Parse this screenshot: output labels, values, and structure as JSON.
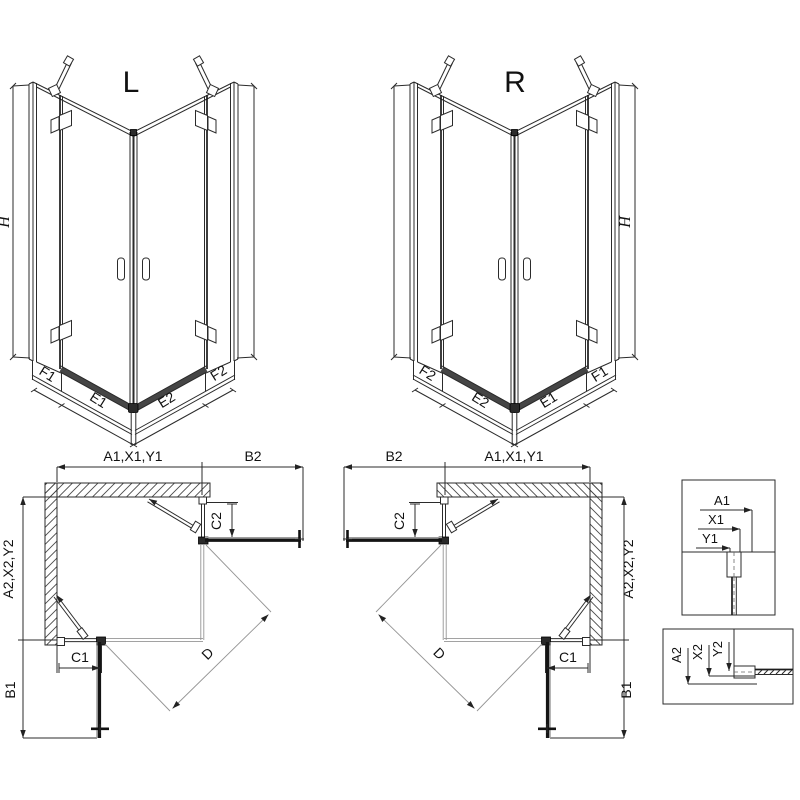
{
  "figure": {
    "background": "#ffffff",
    "line_color": "#2b2b2b",
    "threshold_color": "#454545",
    "door_bar_color": "#141414"
  },
  "iso_left": {
    "title": "L",
    "height_label": "H",
    "edge_labels": [
      "F1",
      "E1",
      "E2",
      "F2"
    ]
  },
  "iso_right": {
    "title": "R",
    "height_label": "H",
    "edge_labels": [
      "F2",
      "E2",
      "E1",
      "F1"
    ]
  },
  "plan_left": {
    "width_top": "A1,X1,Y1",
    "clearance_top": "B2",
    "fixed_top": "C2",
    "depth_side": "A2,X2,Y2",
    "fixed_front": "C1",
    "clearance_front": "B1",
    "diagonal": "D"
  },
  "plan_right": {
    "width_top": "A1,X1,Y1",
    "clearance_top": "B2",
    "fixed_top": "C2",
    "depth_side": "A2,X2,Y2",
    "fixed_front": "C1",
    "clearance_front": "B1",
    "diagonal": "D"
  },
  "detail_width": {
    "labels": [
      "A1",
      "X1",
      "Y1"
    ]
  },
  "detail_depth": {
    "labels": [
      "A2",
      "X2",
      "Y2"
    ]
  }
}
